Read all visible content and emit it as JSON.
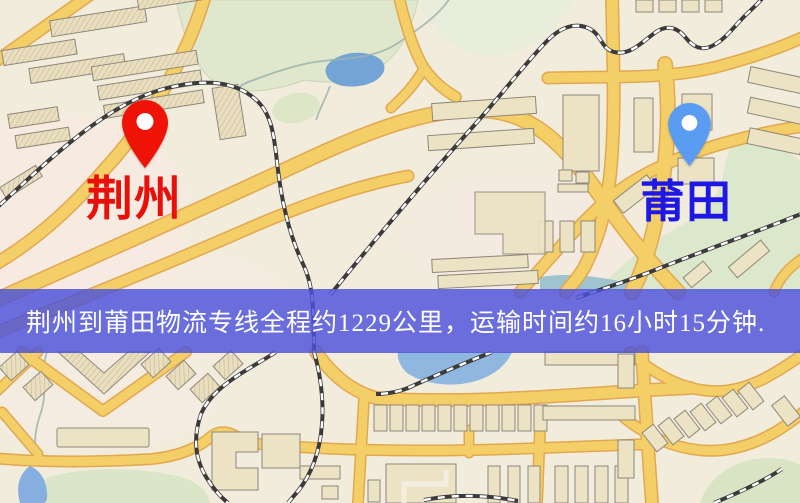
{
  "banner": {
    "text": "荆州到莆田物流专线全程约1229公里，运输时间约16小时15分钟.",
    "background_color": "rgba(76,80,218,0.82)",
    "text_color": "#ffffff"
  },
  "map": {
    "origin": {
      "label": "荆州",
      "label_color": "#e8100a",
      "pin_color": "#ee1207",
      "pin_icon": "red-map-pin"
    },
    "destination": {
      "label": "莆田",
      "label_color": "#1d18e4",
      "pin_color": "#5b9cf3",
      "pin_icon": "blue-map-pin"
    },
    "palette": {
      "background": "#f2ecdd",
      "road_fill": "#f4cf68",
      "road_casing": "#e2a850",
      "building_fill": "#ece2c4",
      "building_outline": "#8e887a",
      "park_green": "#dfe7cc",
      "water_blue": "#74a3d6",
      "railway_dark": "#3b3b3b"
    }
  }
}
